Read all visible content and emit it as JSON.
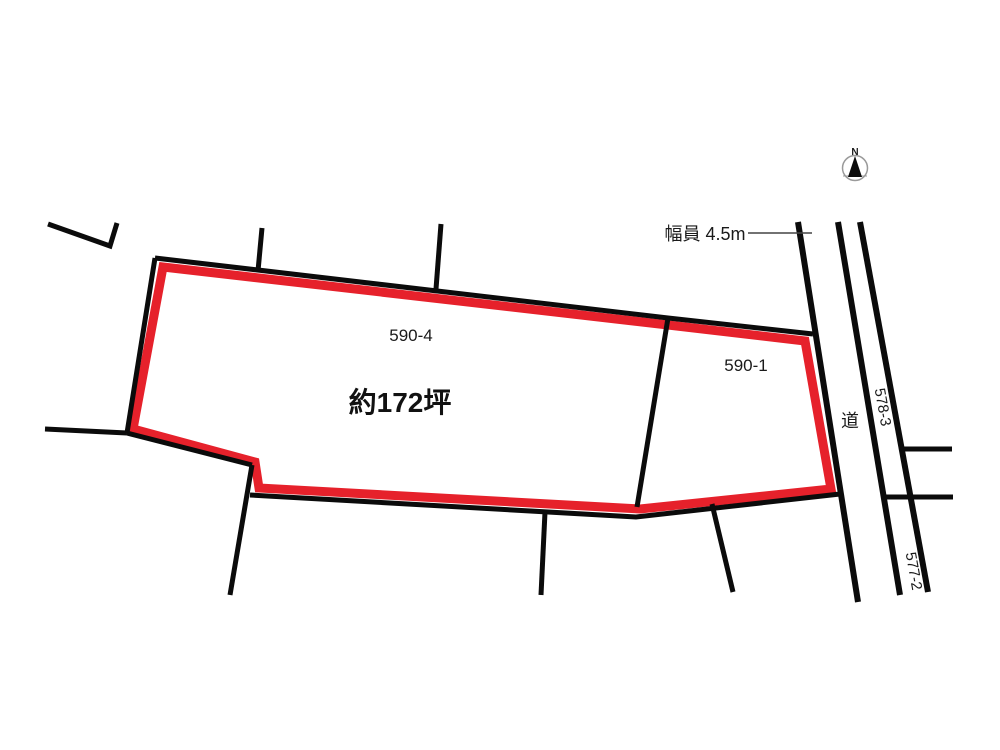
{
  "diagram": {
    "north_label": "N",
    "road_width_label": "幅員 4.5m",
    "area_label": "約172坪",
    "road_label": "道",
    "parcel_main_label": "590-4",
    "parcel_secondary_label": "590-1",
    "parcel_east_north_label": "578-3",
    "parcel_east_south_label": "577-2",
    "colors": {
      "highlight_red": "#e6212b",
      "line_black": "#0b0b0b",
      "background": "#ffffff"
    }
  }
}
